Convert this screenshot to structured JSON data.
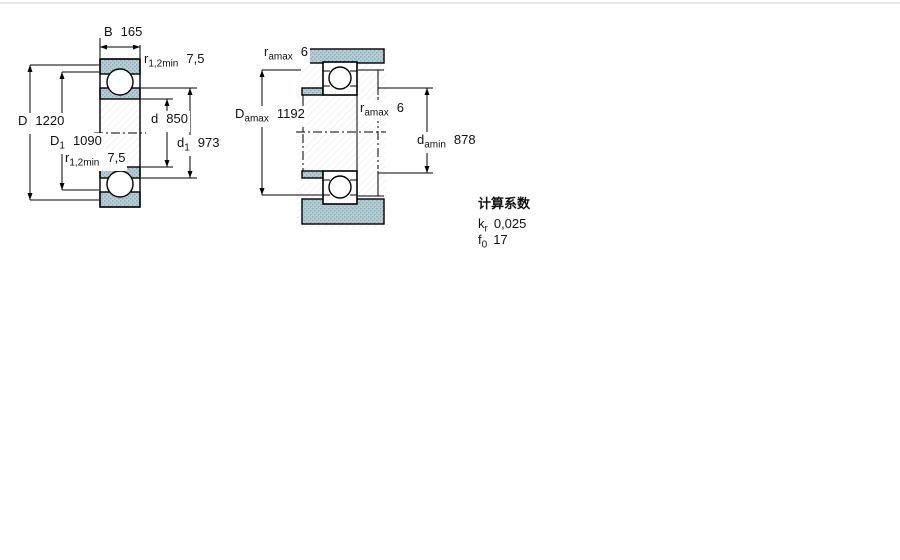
{
  "figure_left": {
    "name": "bearing cross-section drawing",
    "B": {
      "sym": "B",
      "sub": "",
      "value": "165"
    },
    "r_top": {
      "sym": "r",
      "sub": "1,2min",
      "value": "7,5"
    },
    "D": {
      "sym": "D",
      "sub": "",
      "value": "1220"
    },
    "D1": {
      "sym": "D",
      "sub": "1",
      "value": "1090"
    },
    "r_bottom": {
      "sym": "r",
      "sub": "1,2min",
      "value": "7,5"
    },
    "d": {
      "sym": "d",
      "sub": "",
      "value": "850"
    },
    "d1": {
      "sym": "d",
      "sub": "1",
      "value": "973"
    }
  },
  "figure_right": {
    "name": "abutment and fillet dimensions drawing",
    "ra_top": {
      "sym": "r",
      "sub": "amax",
      "value": "6"
    },
    "Damax": {
      "sym": "D",
      "sub": "amax",
      "value": "1192"
    },
    "ra_mid": {
      "sym": "r",
      "sub": "amax",
      "value": "6"
    },
    "damin": {
      "sym": "d",
      "sub": "amin",
      "value": "878"
    }
  },
  "calc": {
    "heading": "计算系数",
    "kr": {
      "sym": "k",
      "sub": "r",
      "value": "0,025"
    },
    "f0": {
      "sym": "f",
      "sub": "0",
      "value": "17"
    }
  },
  "colors": {
    "fill": "#b3cedb",
    "dot": "#8fa9a4",
    "line": "#000000",
    "hatch": "#e8e8e8"
  }
}
